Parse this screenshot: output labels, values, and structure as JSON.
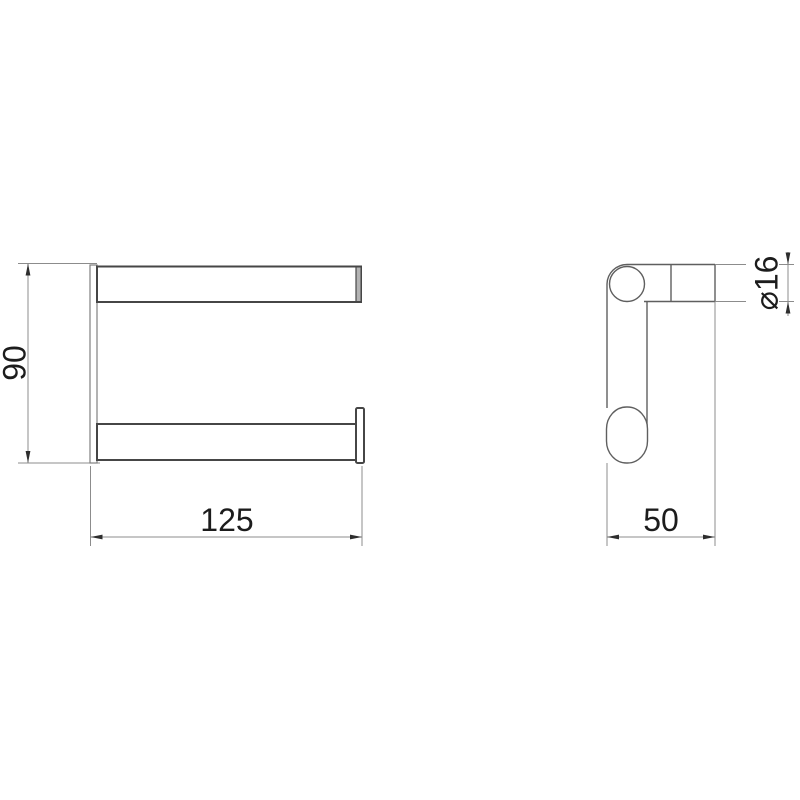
{
  "colors": {
    "background": "#ffffff",
    "part_line": "#464646",
    "side_line": "#5f5f5f",
    "edge_line": "#808080",
    "dim_line": "#8c8c8c",
    "arrow": "#2e2e2e",
    "text": "#1c1c1c",
    "cap_fill": "#b3b3b3"
  },
  "front_view": {
    "height_dim": "90",
    "width_dim": "125"
  },
  "side_view": {
    "diameter_dim": "⌀16",
    "depth_dim": "50"
  }
}
